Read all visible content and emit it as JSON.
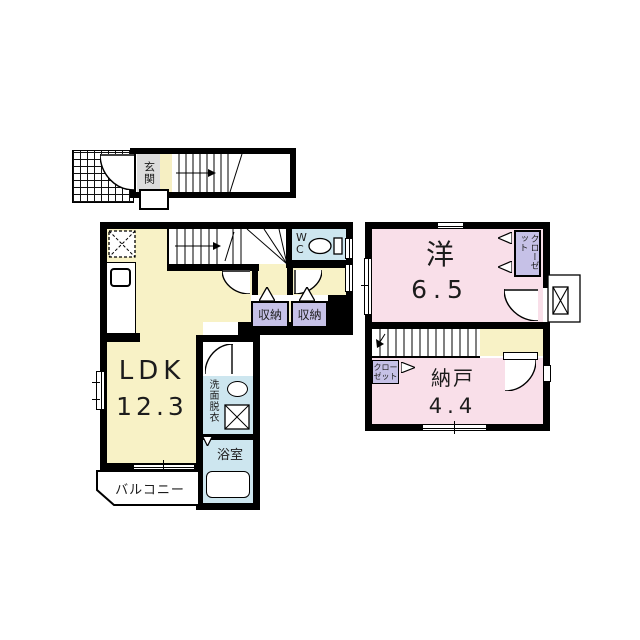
{
  "floorplan": {
    "floor1": {
      "entrance_label": "玄関"
    },
    "floor2": {
      "ldk": {
        "name": "LDK",
        "area": "12.3"
      },
      "wc_label": "WC",
      "storage_left_label": "収納",
      "storage_right_label": "収納",
      "washroom_label": "洗面脱衣",
      "bath_label": "浴室",
      "balcony_label": "バルコニー"
    },
    "floor3": {
      "western_room": {
        "name": "洋",
        "area": "6.5"
      },
      "closet_label": "クローゼット",
      "closet_small_label": "クロー\nゼット",
      "storage_room": {
        "name": "納戸",
        "area": "4.4"
      }
    },
    "colors": {
      "wall": "#000000",
      "room_yellow": "#f8f2c6",
      "room_pink": "#f9dfe9",
      "room_blue": "#cde6ef",
      "closet_purple": "#c6c1e7",
      "entrance_gray": "#dcdcdc",
      "strip_yellow": "#f6efc3"
    }
  }
}
